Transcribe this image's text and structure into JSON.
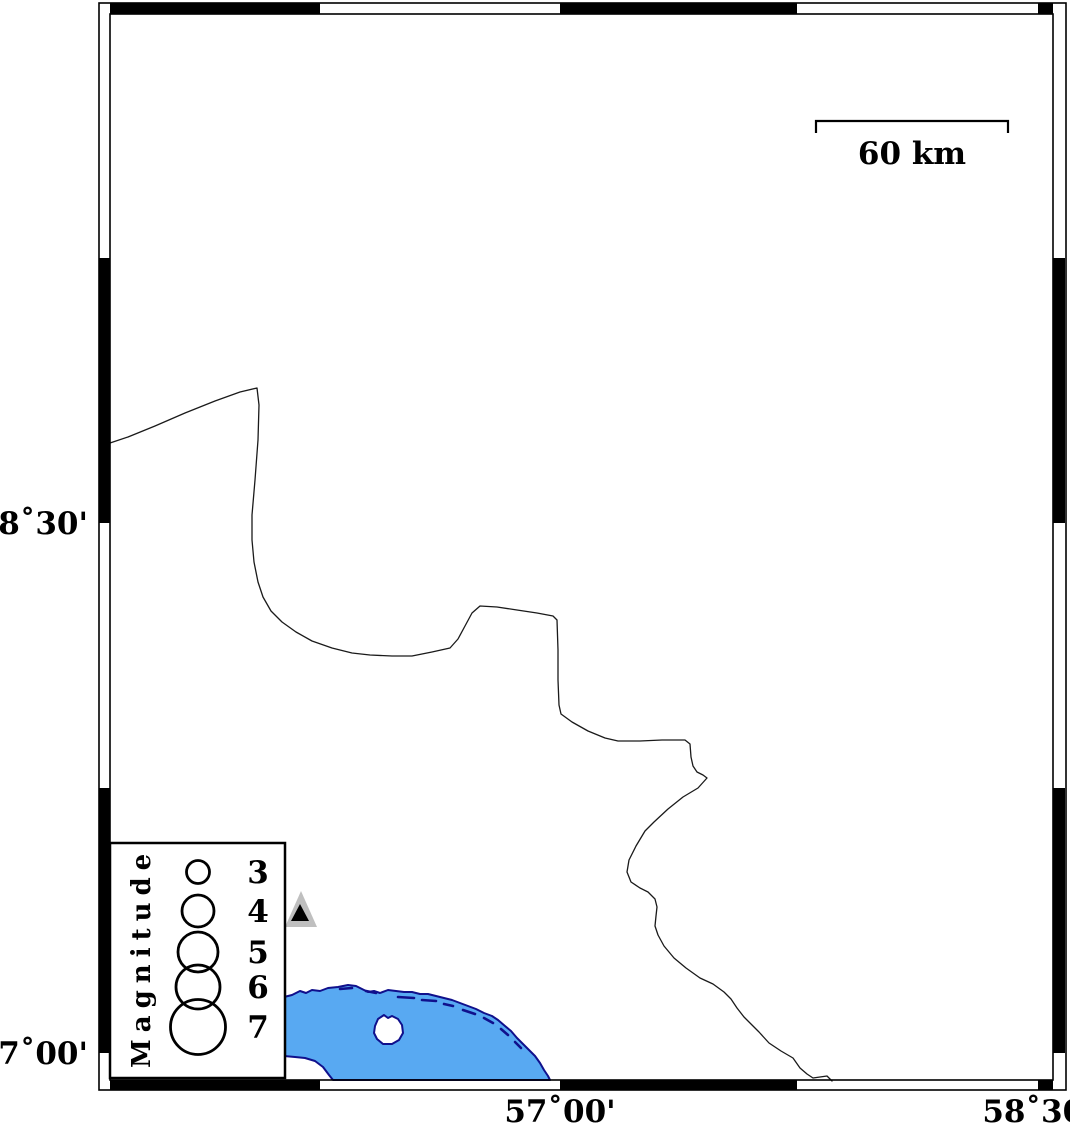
{
  "colors": {
    "sea_fill": "#58a9f2",
    "coast_outline": "#10108c",
    "frame_black": "#000000",
    "triangle_gray": "#bfbfbf",
    "triangle_black": "#000000",
    "background": "#ffffff"
  },
  "axes": {
    "left": [
      {
        "label": "28˚30'"
      },
      {
        "label": "27˚00'"
      }
    ],
    "bottom": [
      {
        "label": "57˚00'"
      },
      {
        "label": "58˚30'"
      }
    ]
  },
  "scale_bar": {
    "label": "60 km"
  },
  "legend": {
    "title": "Magnitude",
    "entries": [
      {
        "magnitude": "3"
      },
      {
        "magnitude": "4"
      },
      {
        "magnitude": "5"
      },
      {
        "magnitude": "6"
      },
      {
        "magnitude": "7"
      }
    ]
  }
}
